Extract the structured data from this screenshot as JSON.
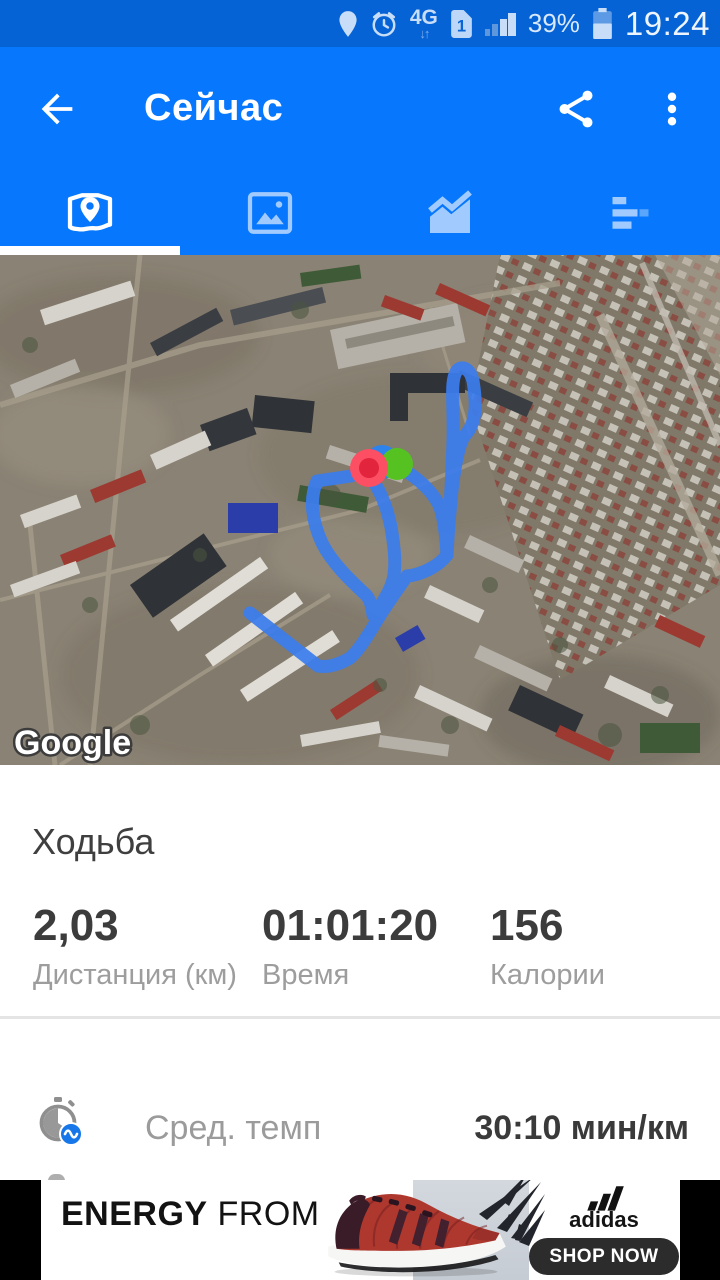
{
  "status_bar": {
    "time": "19:24",
    "battery": "39%",
    "network_label": "4G",
    "sim_label": "1",
    "arrows": "↓↑"
  },
  "app_bar": {
    "title": "Сейчас"
  },
  "tabs": {
    "items": [
      {
        "id": "map",
        "active": true
      },
      {
        "id": "photos",
        "active": false
      },
      {
        "id": "chart",
        "active": false
      },
      {
        "id": "list",
        "active": false
      }
    ]
  },
  "map": {
    "attribution": "Google"
  },
  "activity": {
    "name": "Ходьба",
    "stats": [
      {
        "value": "2,03",
        "label": "Дистанция (км)"
      },
      {
        "value": "01:01:20",
        "label": "Время"
      },
      {
        "value": "156",
        "label": "Калории"
      }
    ],
    "details": [
      {
        "label": "Сред. темп",
        "value": "30:10 мин/км"
      }
    ]
  },
  "ad": {
    "headline": {
      "l1_strong": "ENERGY",
      "l1_rest": " FROM",
      "l2_pre": "THE ",
      "l2_strong": "GROUND",
      "l2_rest": " UP"
    },
    "brand": "adidas",
    "cta": "SHOP NOW"
  },
  "colors": {
    "status_bar": "#0563d6",
    "app_bar": "#0778fd",
    "route": "#3b7ded",
    "marker_start": "#56c222",
    "marker_end": "#fd4f63",
    "badge": "#1877e8"
  }
}
